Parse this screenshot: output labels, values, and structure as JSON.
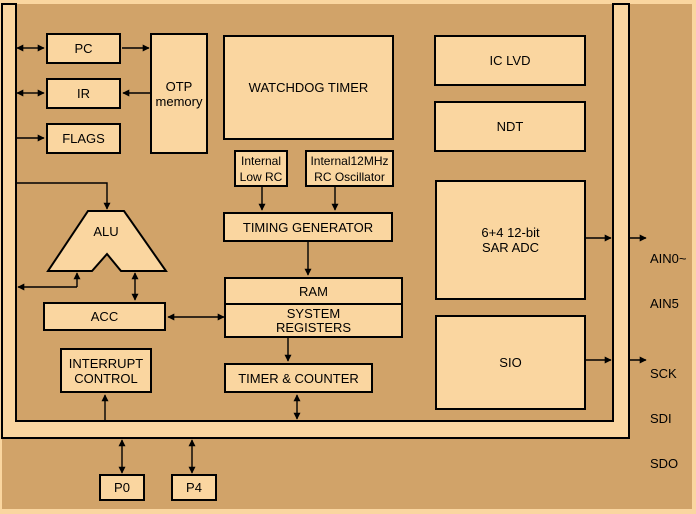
{
  "colors": {
    "background": "#D1A369",
    "block_fill": "#FAD6A0",
    "line": "#000000"
  },
  "blocks": {
    "pc": {
      "label": "PC"
    },
    "ir": {
      "label": "IR"
    },
    "flags": {
      "label": "FLAGS"
    },
    "otp": {
      "line1": "OTP",
      "line2": "memory"
    },
    "watchdog": {
      "label": "WATCHDOG TIMER"
    },
    "low_rc": {
      "line1": "Internal",
      "line2": "Low RC"
    },
    "rc_osc": {
      "line1": "Internal12MHz",
      "line2": "RC Oscillator"
    },
    "timing": {
      "label": "TIMING GENERATOR"
    },
    "ram": {
      "label": "RAM"
    },
    "sys_reg": {
      "line1": "SYSTEM",
      "line2": "REGISTERS"
    },
    "timer": {
      "label": "TIMER & COUNTER"
    },
    "alu": {
      "label": "ALU"
    },
    "acc": {
      "label": "ACC"
    },
    "interrupt": {
      "line1": "INTERRUPT",
      "line2": "CONTROL"
    },
    "ic_lvd": {
      "label": "IC LVD"
    },
    "ndt": {
      "label": "NDT"
    },
    "adc": {
      "line1": "6+4 12-bit",
      "line2": "SAR ADC"
    },
    "sio": {
      "label": "SIO"
    },
    "p0": {
      "label": "P0"
    },
    "p4": {
      "label": "P4"
    }
  },
  "pin_labels": {
    "adc_pins": {
      "line1": "AIN0~",
      "line2": "AIN5"
    },
    "sio_pins": {
      "line1": "SCK",
      "line2": "SDI",
      "line3": "SDO"
    }
  }
}
